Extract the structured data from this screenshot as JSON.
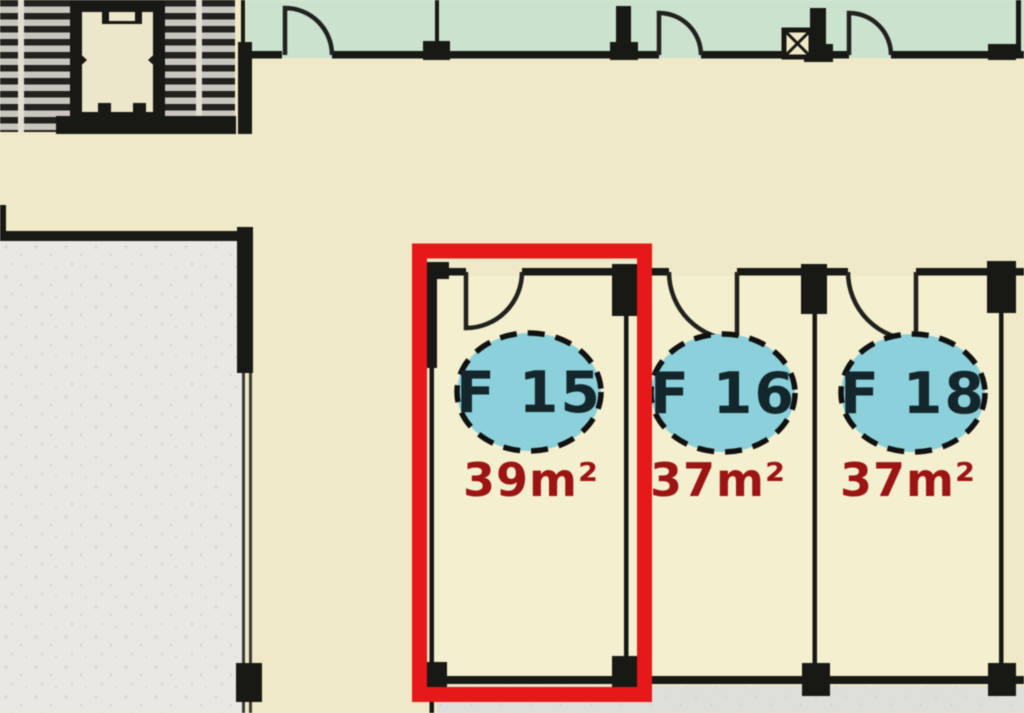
{
  "units": [
    {
      "id": "F 15",
      "area": "39m²",
      "selected": true
    },
    {
      "id": "F 16",
      "area": "37m²",
      "selected": false
    },
    {
      "id": "F 18",
      "area": "37m²",
      "selected": false
    }
  ],
  "icons": {
    "stairs": "stairs-treads-icon",
    "elevator": "elevator-icon",
    "shaft": "shaft-x-icon",
    "door": "door-swing-icon",
    "selection": "selection-highlight"
  },
  "colors": {
    "floor_cream": "#efe9c7",
    "unit_floor": "#f4efce",
    "room_mint": "#cbe2cf",
    "terrace_gray": "#e9e8e4",
    "bottom_gray": "#dededa",
    "wall_black": "#181815",
    "stair_tread": "#23221e",
    "badge_teal": "#8bd0da",
    "badge_border": "#111111",
    "unit_id_text": "#13262c",
    "area_text_red": "#9c1414",
    "highlight_red": "#e5191a"
  }
}
